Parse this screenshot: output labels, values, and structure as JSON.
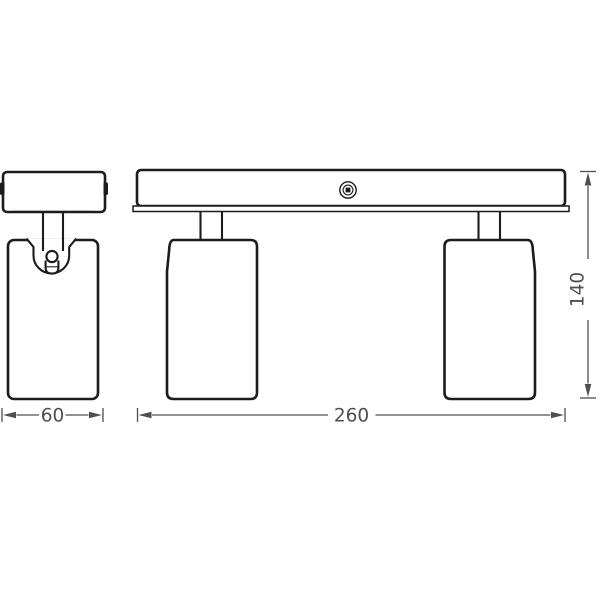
{
  "colors": {
    "outline": "#1c1c1c",
    "dimension": "#4f4f4f",
    "background": "#ffffff"
  },
  "dimensions": {
    "head_width": {
      "value": "60"
    },
    "overall_width": {
      "value": "260"
    },
    "overall_height": {
      "value": "140"
    }
  }
}
